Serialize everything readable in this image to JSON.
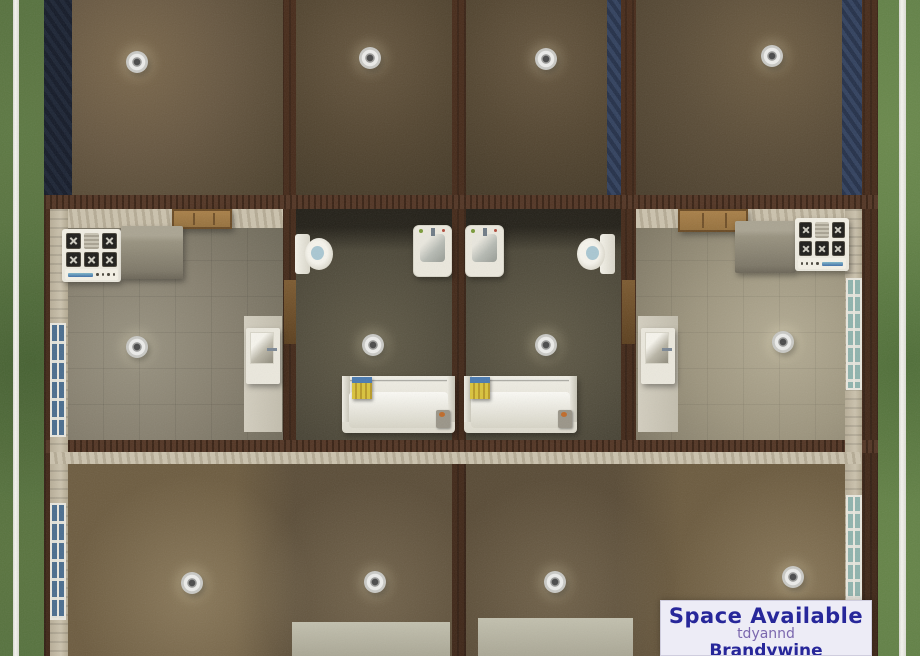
{
  "overlay_sign": {
    "title": "Space Available",
    "creator": "tdyannd",
    "lot_name": "Brandywine Apartments"
  },
  "colors": {
    "grass": "#5d7c44",
    "fence": "#f4f4ee",
    "wall": "#3e2617",
    "wall_grain": "#4b2d1b",
    "siding": "#cbc2ad",
    "stripes": "#32415e",
    "stripes_dark": "#243049",
    "white_fixture": "#ebe8dd",
    "counter": "#98927f",
    "door_wood": "#96713d",
    "towel": "#d9c33c",
    "toilet_water": "#a9c7d2",
    "window_blue": "#4a6d8e",
    "window_teal": "#8fb3ad",
    "sign_bg": "#edecf6",
    "sign_title": "#27279a",
    "sign_creator": "#7b68ae"
  }
}
